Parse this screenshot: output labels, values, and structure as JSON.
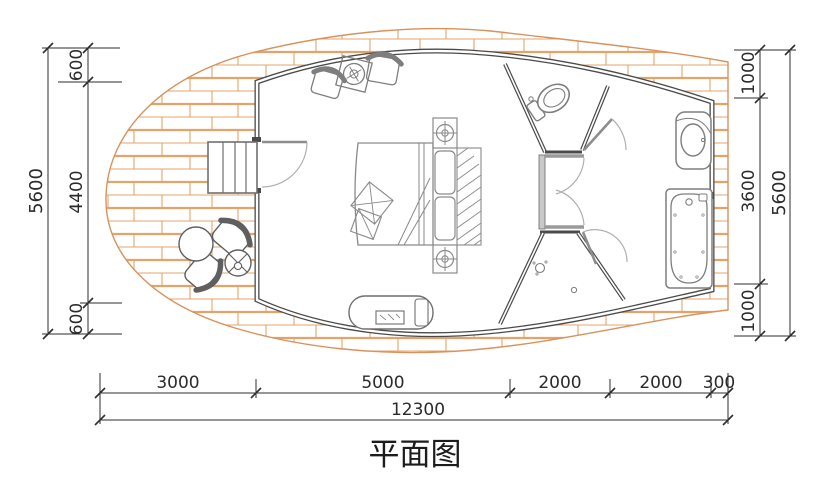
{
  "title": {
    "text": "平面图"
  },
  "dims": {
    "left_outer_total": "5600",
    "left_chain": [
      "600",
      "4400",
      "600"
    ],
    "right_chain": [
      "1000",
      "3600",
      "1000"
    ],
    "right_outer_total": "5600",
    "bottom_chain": [
      "3000",
      "5000",
      "2000",
      "2000",
      "300"
    ],
    "bottom_total": "12300"
  },
  "colors": {
    "brick_line": "#e3a46c",
    "deck_outline": "#d8925c",
    "wall": "#4a4a4a",
    "dim_line": "#2e2e2e"
  }
}
